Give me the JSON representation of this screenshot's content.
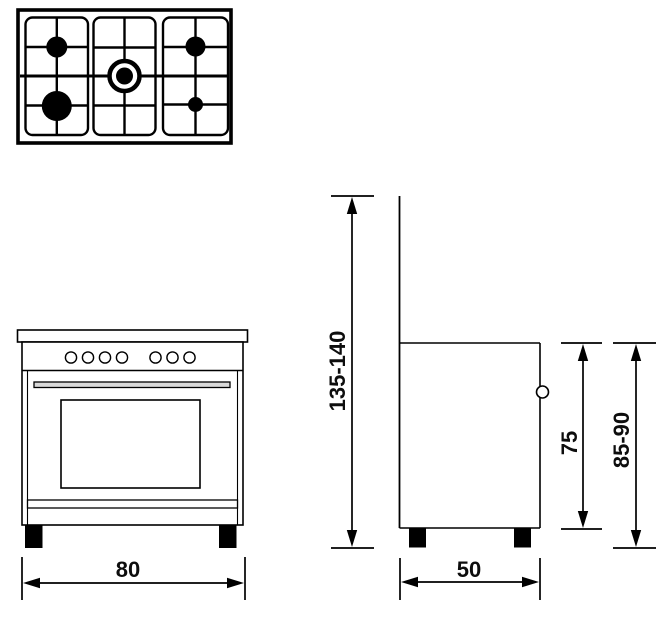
{
  "diagram": {
    "background": "#ffffff",
    "line_color": "#000000",
    "hob_top_view": {
      "label": "5-burner gas hob, top view",
      "burners": [
        {
          "name": "rear-left-burner",
          "size": "medium"
        },
        {
          "name": "front-left-burner",
          "size": "large"
        },
        {
          "name": "center-wok-burner",
          "size": "dual-ring"
        },
        {
          "name": "rear-right-burner",
          "size": "medium"
        },
        {
          "name": "front-right-burner",
          "size": "small"
        }
      ],
      "grid_sections": 3
    },
    "front_view": {
      "label": "cooker front view",
      "knob_count": 7,
      "feet_count": 2
    },
    "side_view": {
      "label": "cooker side view",
      "handle_knob": true,
      "feet_count": 2
    },
    "dimensions": {
      "width": "80",
      "depth": "50",
      "body_height": "75",
      "worktop_height": "85-90",
      "overall_height": "135-140"
    }
  }
}
